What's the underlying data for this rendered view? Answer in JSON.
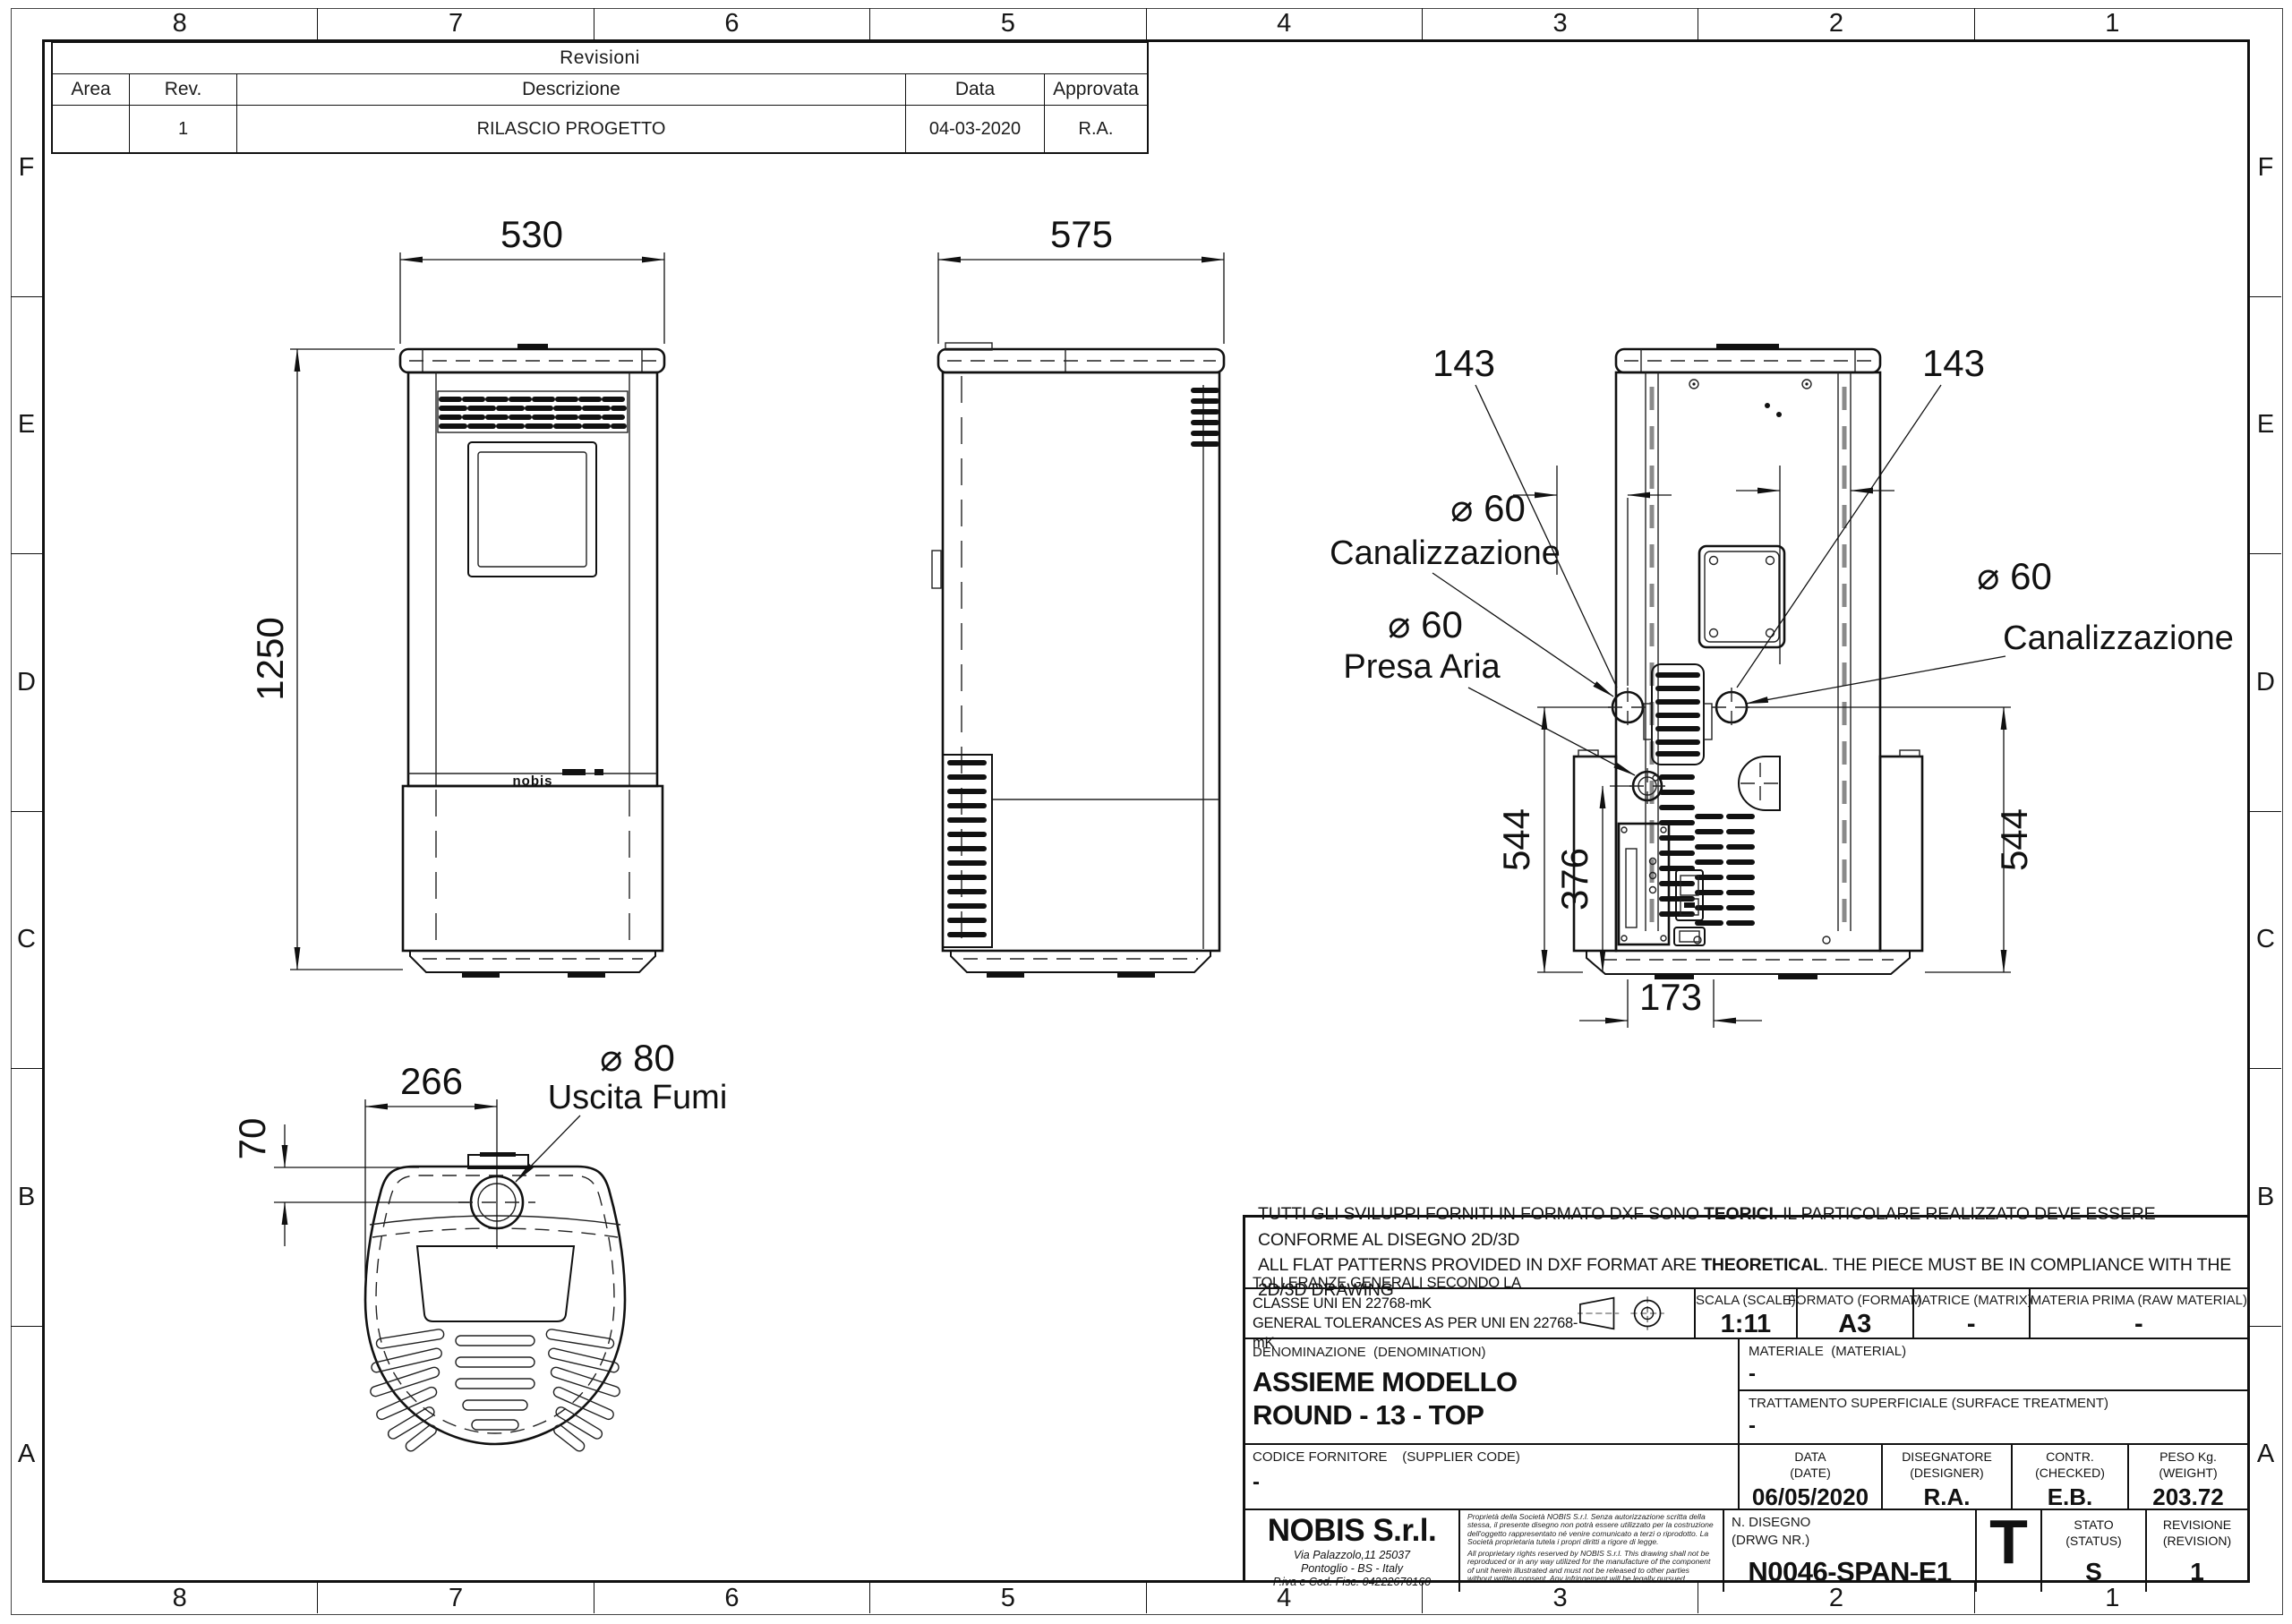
{
  "sheet": {
    "cols": [
      "8",
      "7",
      "6",
      "5",
      "4",
      "3",
      "2",
      "1"
    ],
    "rows": [
      "F",
      "E",
      "D",
      "C",
      "B",
      "A"
    ]
  },
  "revisions": {
    "title": "Revisioni",
    "col_area": "Area",
    "col_rev": "Rev.",
    "col_desc": "Descrizione",
    "col_date": "Data",
    "col_approved": "Approvata",
    "row1": {
      "area": "",
      "rev": "1",
      "desc": "RILASCIO PROGETTO",
      "date": "04-03-2020",
      "approved": "R.A."
    }
  },
  "drawing": {
    "front_width": "530",
    "front_height": "1250",
    "side_depth": "575",
    "back_left_offset": "143",
    "back_right_offset": "143",
    "duct_left_dia": "⌀ 60",
    "duct_left_name": "Canalizzazione",
    "air_intake_dia": "⌀ 60",
    "air_intake_name": "Presa Aria",
    "duct_right_dia": "⌀ 60",
    "duct_right_name": "Canalizzazione",
    "back_height_left": "544",
    "back_height_right": "544",
    "air_intake_height": "376",
    "duct_spacing": "173",
    "top_offset_x": "266",
    "top_offset_y": "70",
    "flue_dia": "⌀ 80",
    "flue_name": "Uscita Fumi",
    "logo": "nobis"
  },
  "title_block": {
    "disclaimer": {
      "it_a": "TUTTI GLI SVILUPPI FORNITI IN FORMATO DXF SONO ",
      "it_b": "TEORICI",
      "it_c": ". IL PARTICOLARE REALIZZATO DEVE ESSERE CONFORME AL DISEGNO 2D/3D",
      "en_a": "ALL FLAT PATTERNS PROVIDED IN DXF FORMAT ARE ",
      "en_b": "THEORETICAL",
      "en_c": ". THE PIECE MUST BE IN COMPLIANCE WITH THE 2D/3D DRAWING"
    },
    "tolerances": {
      "line1": "TOLLERANZE GENERALI SECONDO LA CLASSE UNI EN 22768-mK",
      "line2": "GENERAL TOLERANCES AS PER UNI EN 22768-mK"
    },
    "scale": {
      "label": "SCALA (SCALE)",
      "value": "1:11"
    },
    "format": {
      "label": "FORMATO (FORMAT)",
      "value": "A3"
    },
    "matrix": {
      "label": "MATRICE (MATRIX)",
      "value": "-"
    },
    "raw_material": {
      "label": "MATERIA PRIMA (RAW MATERIAL)",
      "value": "-"
    },
    "denomination": {
      "label": "DENOMINAZIONE  (DENOMINATION)",
      "line1": "ASSIEME MODELLO",
      "line2": "ROUND - 13 - TOP"
    },
    "material": {
      "label": "MATERIALE  (MATERIAL)",
      "value": "-"
    },
    "surface": {
      "label": "TRATTAMENTO SUPERFICIALE (SURFACE TREATMENT)",
      "value": "-"
    },
    "supplier": {
      "label": "CODICE FORNITORE    (SUPPLIER CODE)",
      "value": "-"
    },
    "date": {
      "label1": "DATA",
      "label2": "(DATE)",
      "value": "06/05/2020"
    },
    "designer": {
      "label1": "DISEGNATORE",
      "label2": "(DESIGNER)",
      "value": "R.A."
    },
    "checked": {
      "label1": "CONTR.",
      "label2": "(CHECKED)",
      "value": "E.B."
    },
    "weight": {
      "label1": "PESO Kg.",
      "label2": "(WEIGHT)",
      "value": "203.72"
    },
    "company": {
      "name": "NOBIS S.r.l.",
      "addr1": "Via Palazzolo,11 25037",
      "addr2": "Pontoglio - BS - Italy",
      "addr3": "P.iva e Cod. Fisc. 04222670160"
    },
    "legal": {
      "it": "Proprietà della Società NOBIS S.r.l. Senza autorizzazione scritta della stessa, il presente disegno non potrà essere utilizzato per la costruzione dell'oggetto rappresentato né venire comunicato a terzi o riprodotto. La Società proprietaria tutela i propri diritti a rigore di legge.",
      "en": "All proprietary rights reserved by NOBIS S.r.l. This drawing shall not be reproduced or in any way utilized for the manufacture of the component of unit herein illustrated and must not be released to other parties without written consent. Any infringement will be legally pursued."
    },
    "drawing_number": {
      "label1": "N. DISEGNO",
      "label2": "(DRWG NR.)",
      "value": "N0046-SPAN-E1"
    },
    "type_mark": "T",
    "status": {
      "label1": "STATO",
      "label2": "(STATUS)",
      "value": "S"
    },
    "revision": {
      "label1": "REVISIONE",
      "label2": "(REVISION)",
      "value": "1"
    }
  }
}
